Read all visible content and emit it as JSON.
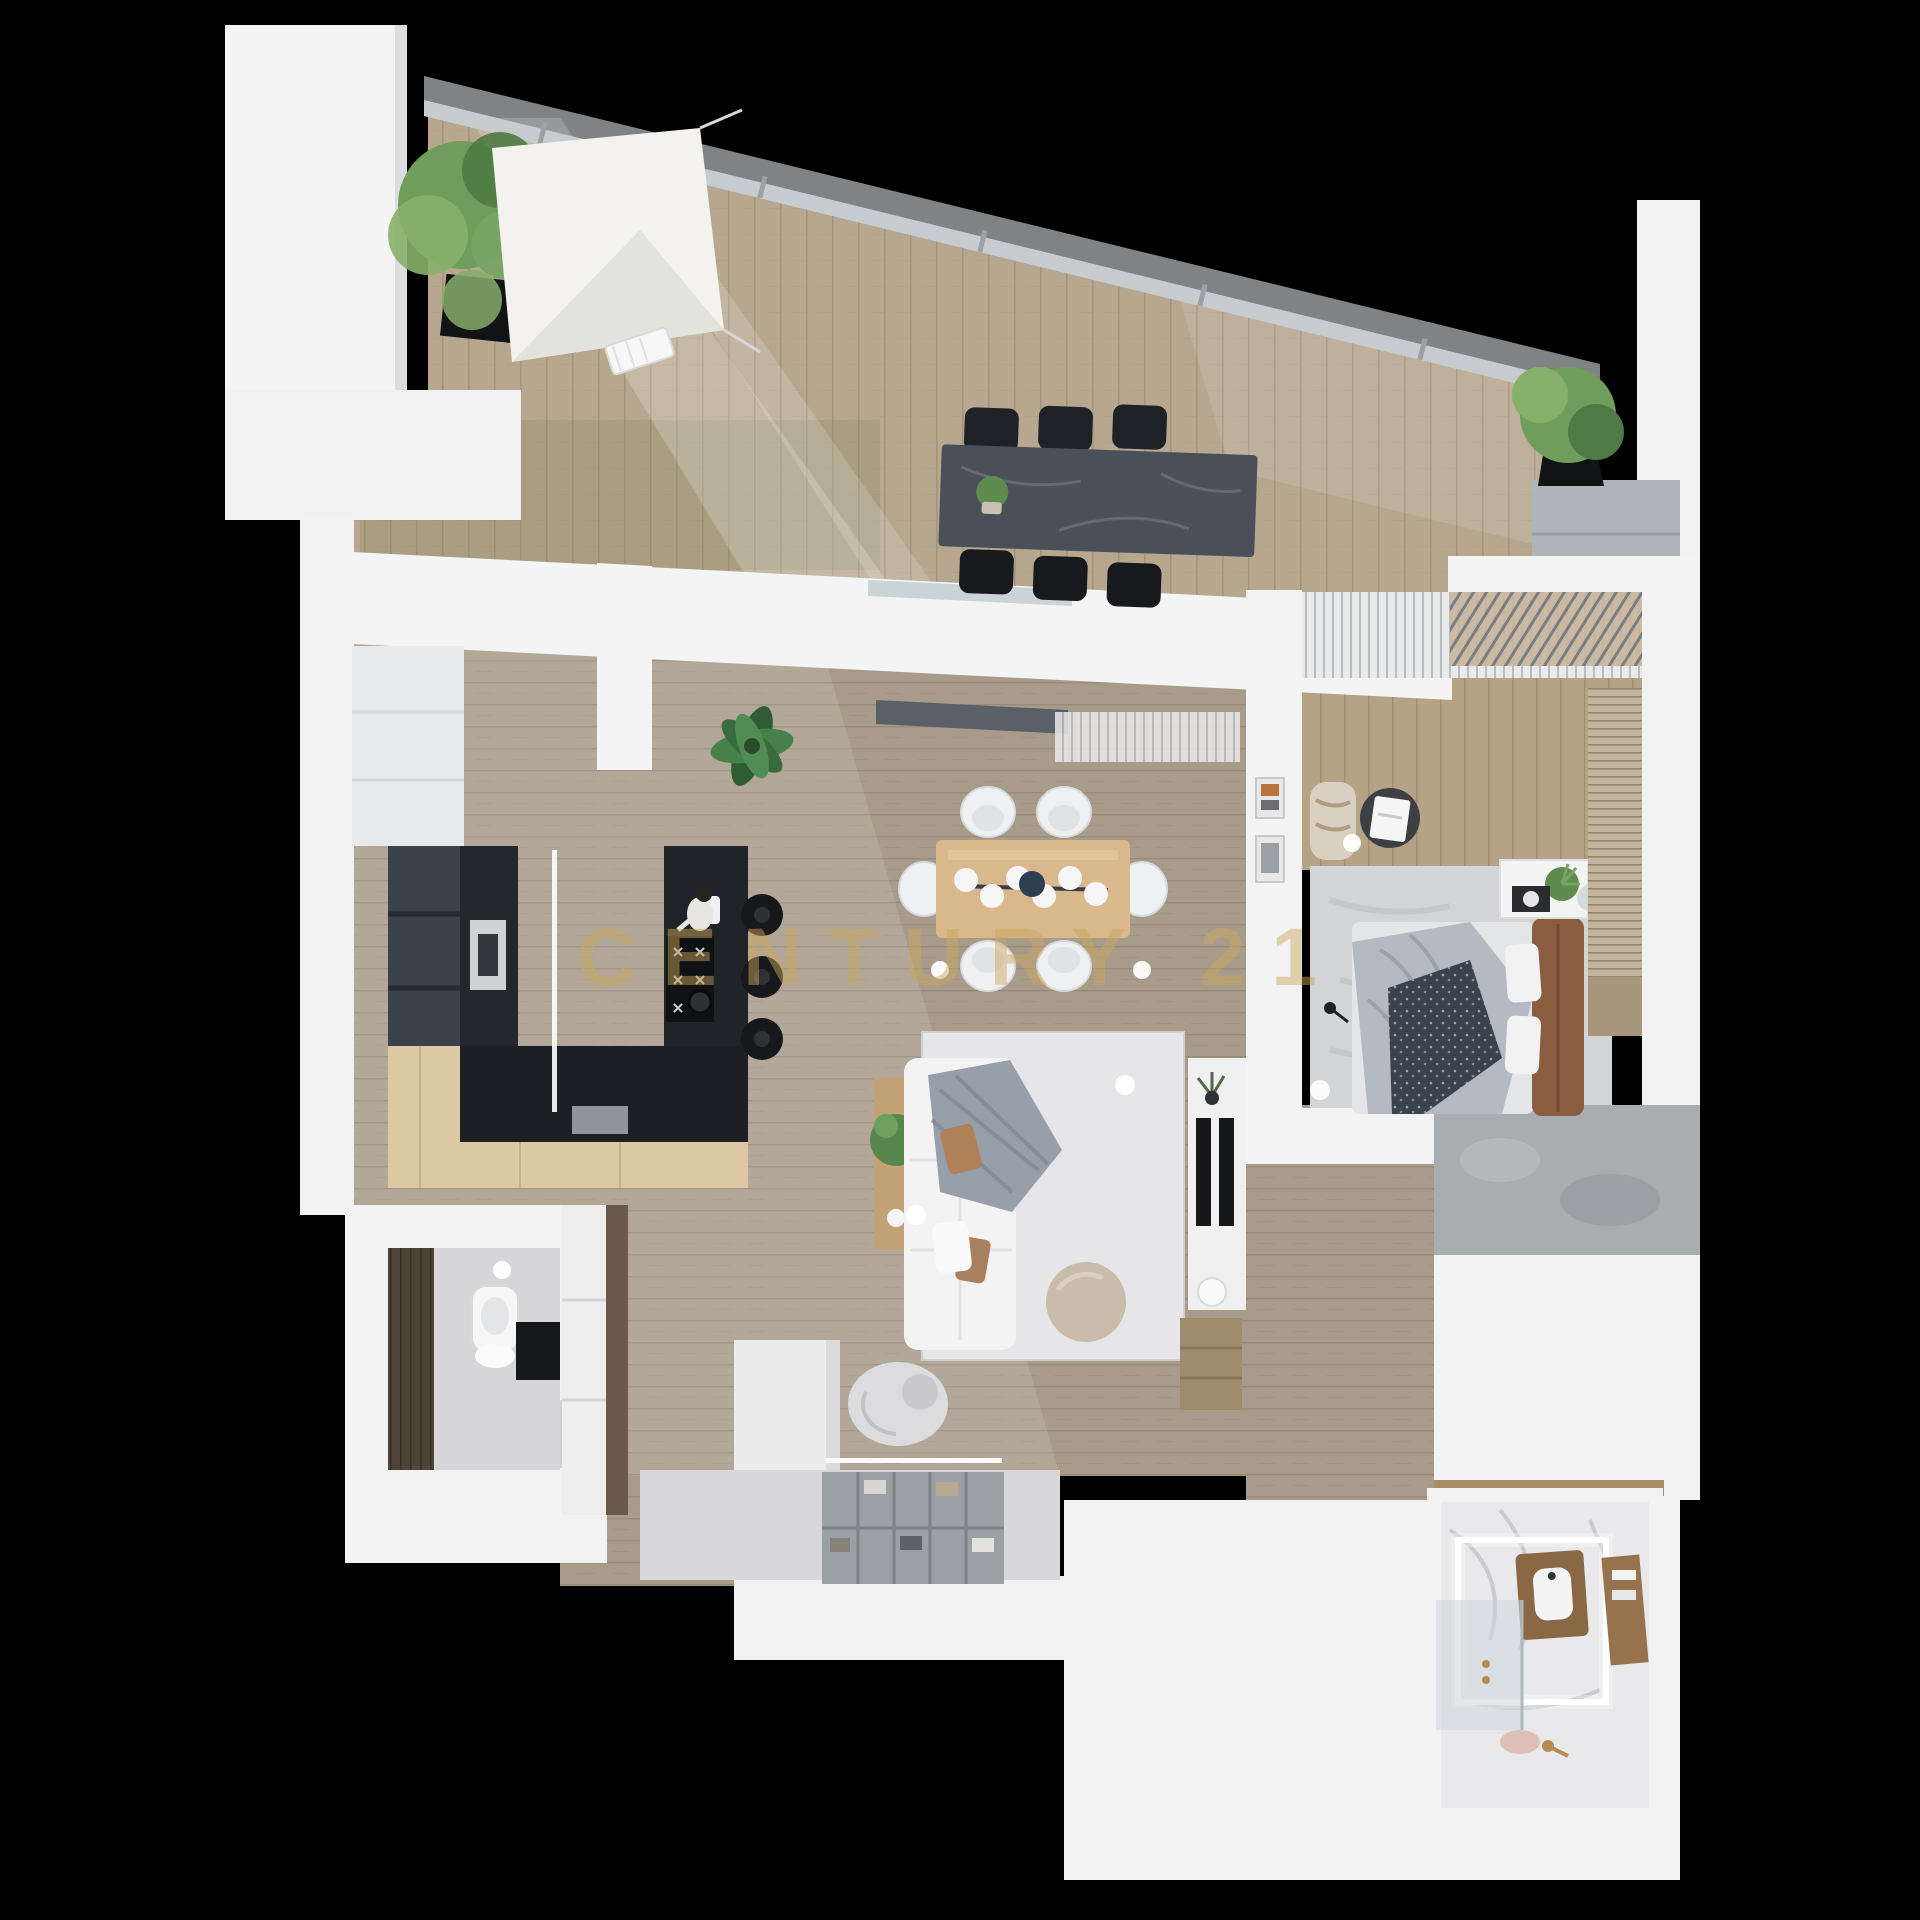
{
  "watermark": {
    "text": "CENTURY 21",
    "color": "#CAA85C",
    "opacity": 0.48
  },
  "scene": {
    "type": "3d-floor-plan-top-down-render",
    "background": "#000000"
  },
  "palette": {
    "background": "#000000",
    "wall_white": "#F2F2F3",
    "wall_shadow": "#D8D9DB",
    "terrace_wood": "#B7A78F",
    "interior_wood": "#A89B8A",
    "bedroom_wood": "#B6A386",
    "glass_railing": "#DFE7EC",
    "kitchen_drawers": "#3C424B",
    "kitchen_tall_unit": "#24272C",
    "kitchen_island": "#202328",
    "breakfast_bar_wood": "#DCC9A4",
    "dining_table_wood": "#D9B98C",
    "dining_chair_white": "#EEF0F2",
    "outdoor_table_stone": "#4A505A",
    "outdoor_chair_black": "#1E2126",
    "sofa_white": "#F3F3F4",
    "throw_gray": "#97A0AA",
    "pillow_brown": "#B08058",
    "living_rug": "#E6E6E8",
    "bedroom_rug": "#D3D4D6",
    "bed_duvet": "#B4BAC1",
    "bed_throw_dark": "#3A424E",
    "headboard_leather": "#8A5C40",
    "plant_green": "#5E8C4E",
    "planter_black": "#121315",
    "marble_floor": "#E9E9EB",
    "vanity_wood": "#8A6844",
    "brass": "#B98A4E",
    "led_light": "#FFFFFF",
    "plaster_gray": "#A8ADB0",
    "wc_accent_wood": "#4E4337"
  },
  "rooms": [
    {
      "id": "terrace",
      "features": [
        "terrace-floor",
        "glass-railing",
        "shade-sail",
        "sun-lounger",
        "planter-left",
        "planter-right",
        "outdoor-dining-table",
        "outdoor-chairs",
        "table-plant",
        "storage-cabinet"
      ]
    },
    {
      "id": "kitchen",
      "features": [
        "white-cabinets",
        "drawer-units",
        "tall-unit-oven",
        "island-cooktop",
        "island-sink",
        "countertop-run",
        "breakfast-bar",
        "bar-stools",
        "led-strip",
        "kitchen-plant",
        "person-figure"
      ]
    },
    {
      "id": "dining-area",
      "features": [
        "dining-table",
        "dining-chairs",
        "chandelier",
        "ceiling-spots"
      ]
    },
    {
      "id": "living-room",
      "features": [
        "area-rug",
        "sofa",
        "knit-throw",
        "pillows",
        "coffee-table",
        "console-table",
        "tv-unit",
        "speakers",
        "floor-lamp",
        "media-steps",
        "armchair",
        "divider-block"
      ]
    },
    {
      "id": "bedroom",
      "features": [
        "window-curtains",
        "pergola-slats",
        "bedroom-rug",
        "bed",
        "duvet",
        "dark-throw",
        "headboard",
        "pillows",
        "nightstand",
        "side-table",
        "bedroom-armchair",
        "art-frames",
        "wardrobe-slats"
      ]
    },
    {
      "id": "wc",
      "features": [
        "dark-wood-accent-wall",
        "toilet",
        "black-vanity",
        "ceiling-light"
      ]
    },
    {
      "id": "entry-hall",
      "features": [
        "wardrobe-doors",
        "wood-accent-strip",
        "entry-mat",
        "shoe-shelf-unit",
        "led-strip"
      ]
    },
    {
      "id": "bathroom",
      "features": [
        "marble-floor",
        "led-floor-frame",
        "wood-vanity",
        "white-basin",
        "shower-glass",
        "wood-shelf",
        "brass-fixtures",
        "bath-mat",
        "wood-threshold"
      ]
    }
  ]
}
